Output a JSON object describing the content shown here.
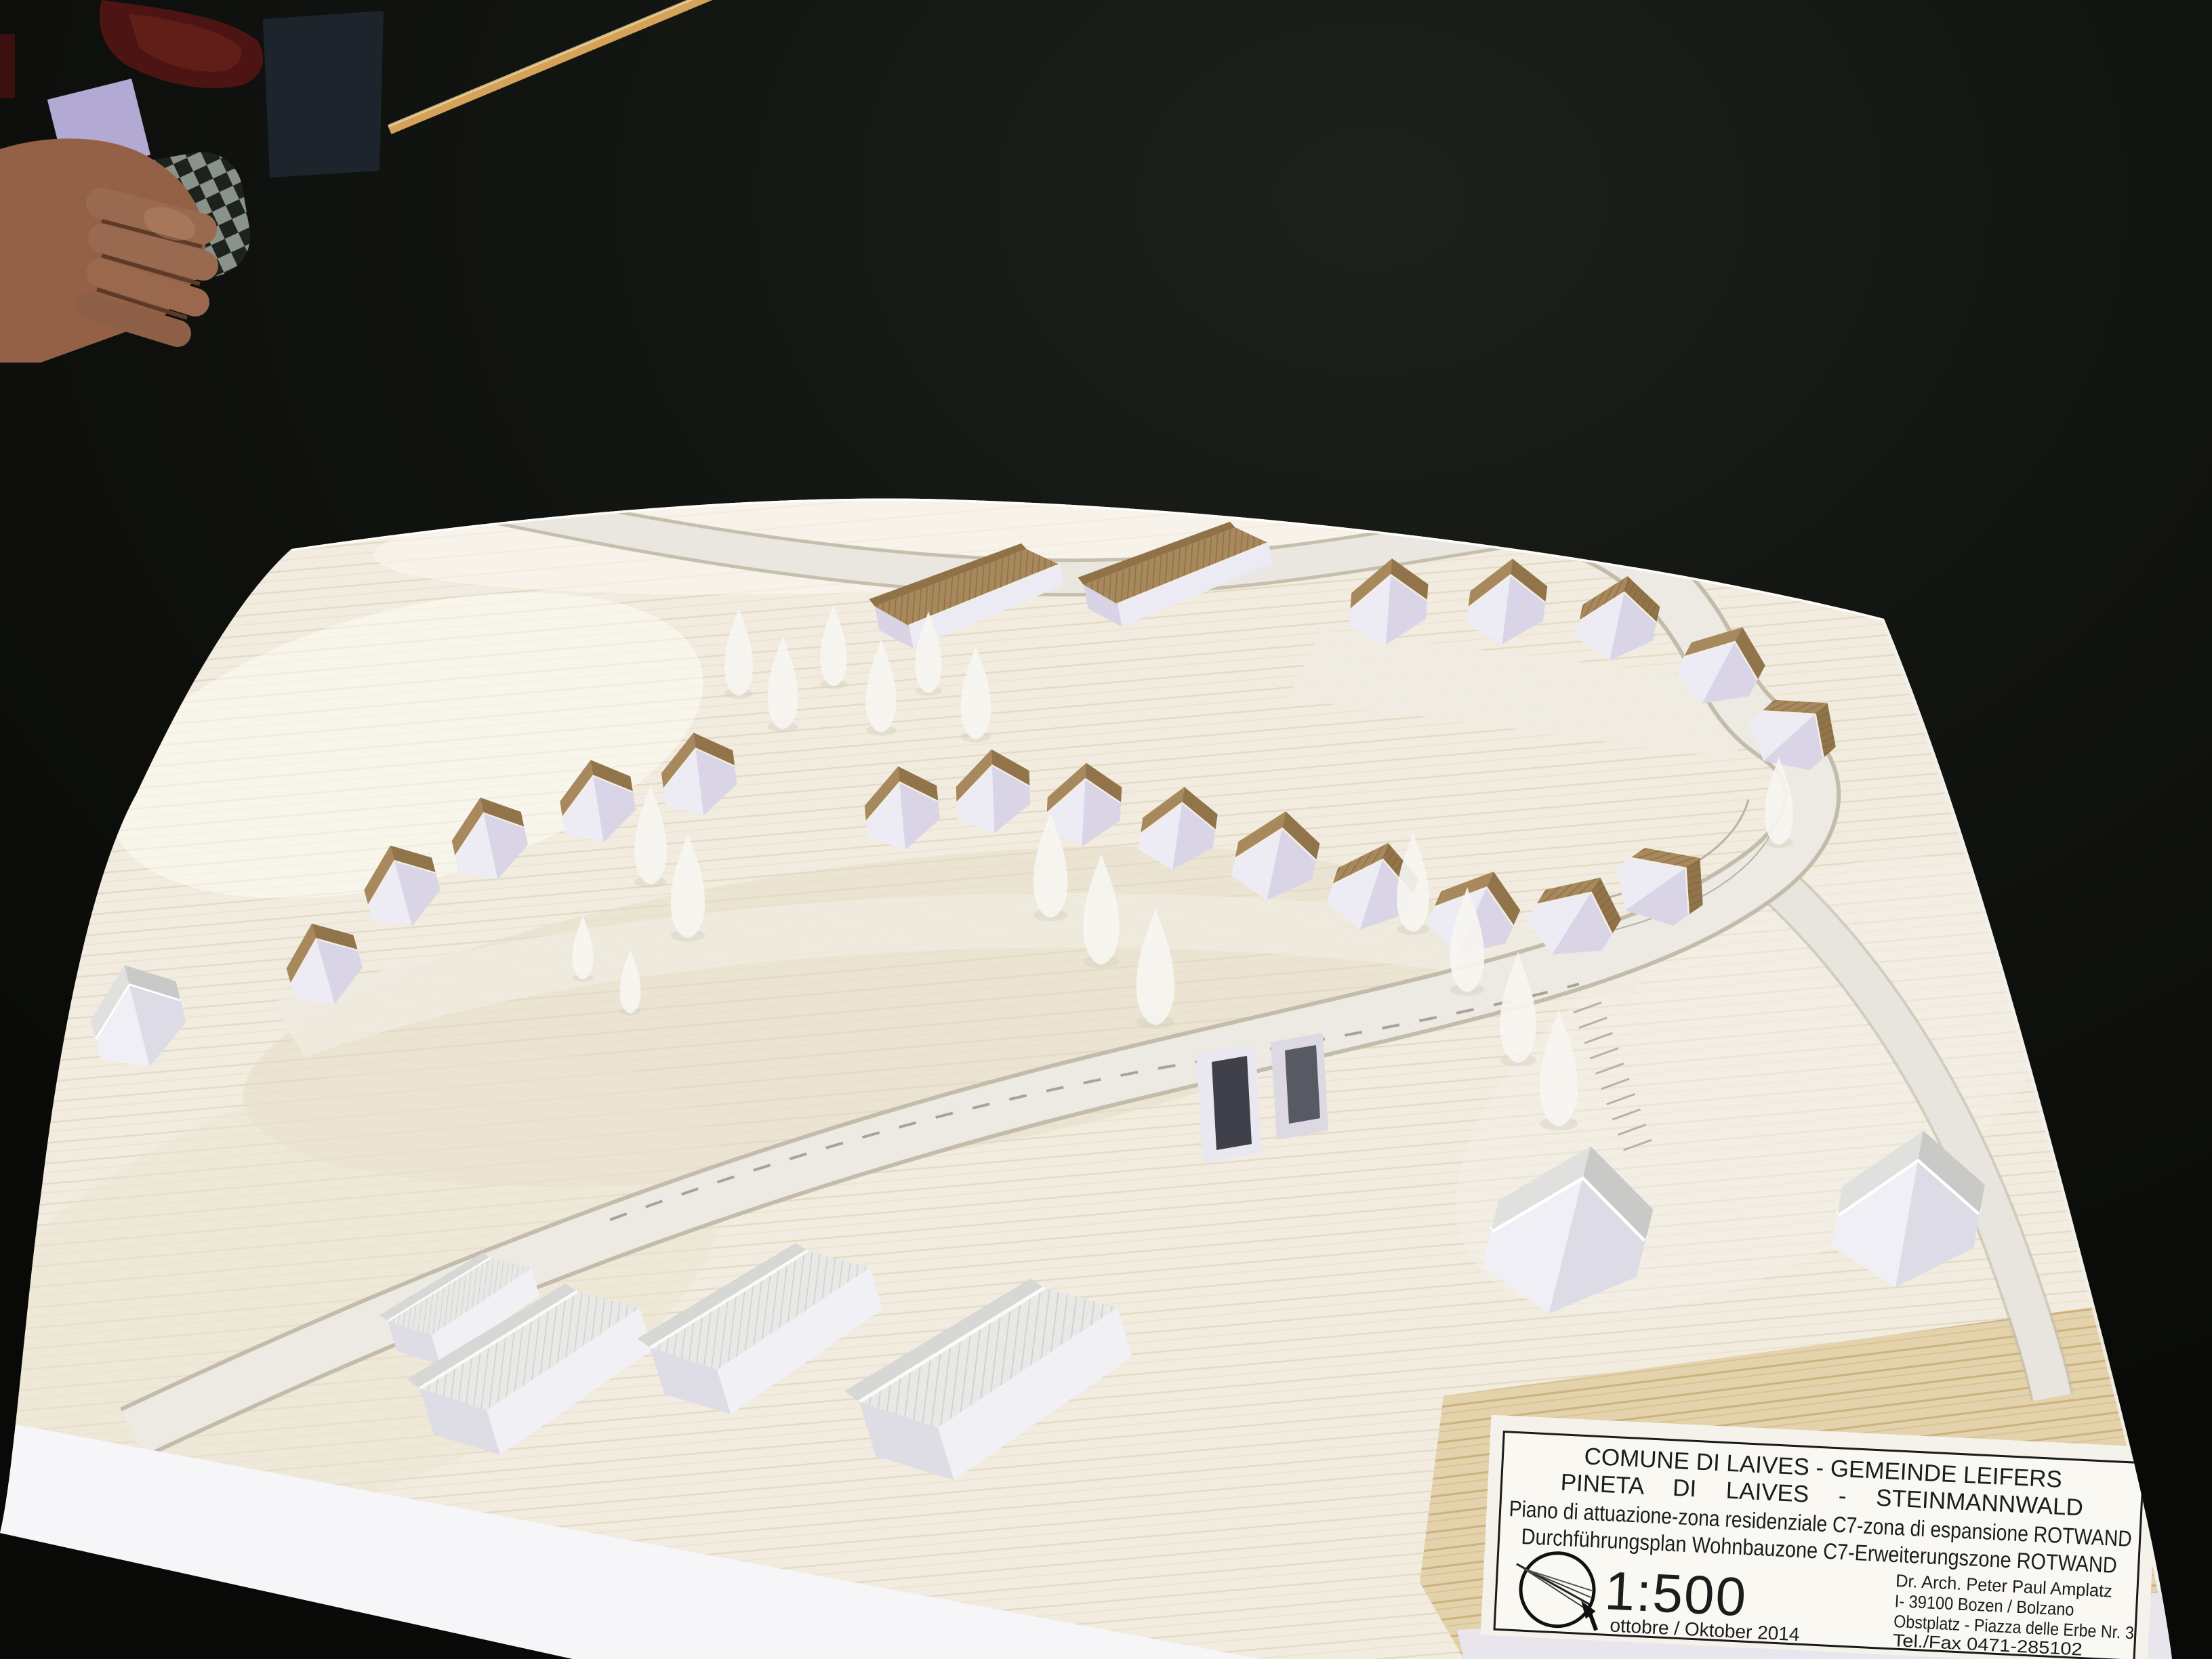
{
  "plaque": {
    "title_line1": "COMUNE DI LAIVES - GEMEINDE LEIFERS",
    "title_line2": "PINETA DI LAIVES  -  STEINMANNWALD",
    "subtitle_line1": "Piano di attuazione-zona residenziale C7-zona di espansione ROTWAND",
    "subtitle_line2": "Durchführungsplan Wohnbauzone C7-Erweiterungszone ROTWAND",
    "scale_label": "1:500",
    "date_label": "ottobre / Oktober 2014",
    "architect_line1": "Dr. Arch. Peter Paul Amplatz",
    "architect_line2": "I- 39100 Bozen / Bolzano",
    "architect_line3": "Obstplatz - Piazza delle Erbe Nr. 3",
    "architect_line4": "Tel./Fax 0471-285102"
  },
  "icons": {
    "scale_logo": "compass-circle-icon"
  },
  "model": {
    "counts": {
      "brown_roof_houses": 19,
      "long_buildings": 2,
      "white_houses": 3,
      "industrial_sheds": 4,
      "trees": 18,
      "garage_entrances": 2
    }
  },
  "colors": {
    "table": "#101210",
    "terrain": "#f1ecdf",
    "road": "#ebe9e2",
    "roof_brown": "#a8895e",
    "roof_brown_shade": "#91744a",
    "wall_white": "#edebf4",
    "roof_white": "#e0e0de",
    "plywood_edge": "#e3d2ab",
    "plaque_bg": "#faf8f2",
    "plaque_text": "#1c1c1c",
    "hand_skin": "#946147",
    "cloth_gray": "#98a198",
    "red_object": "#4c1513",
    "purple_card": "#b2aad2",
    "stick": "#d4a258"
  }
}
